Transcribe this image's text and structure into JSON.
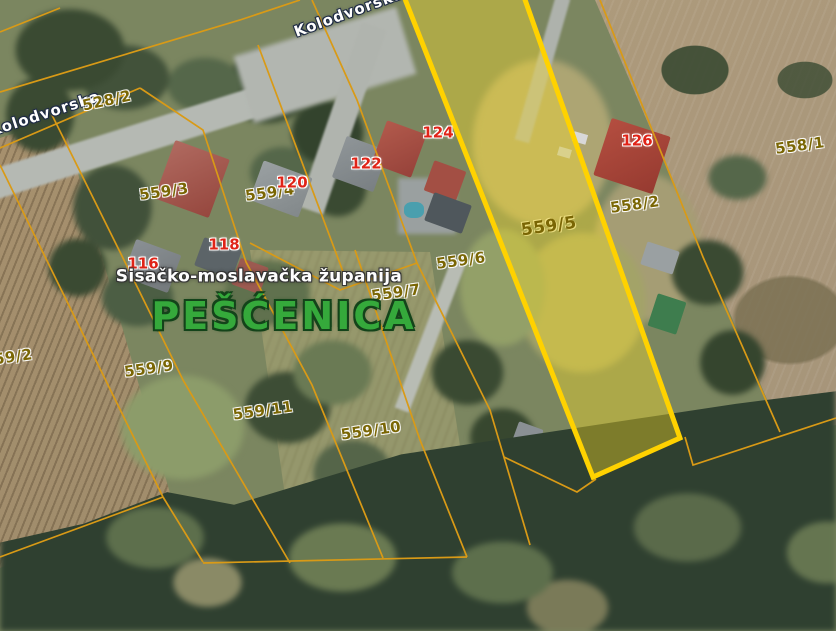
{
  "map": {
    "type": "cadastral-satellite-map",
    "place_label": "PEŠĆENICA",
    "admin_label": "Sisačko-moslavačka županija",
    "street_labels": [
      {
        "text": "Kolodvorska"
      },
      {
        "text": "Kolodvorska"
      }
    ],
    "highlighted_parcel": "559/5",
    "parcel_labels": [
      {
        "label": "528/2"
      },
      {
        "label": "559/3"
      },
      {
        "label": "559/4"
      },
      {
        "label": "559/2"
      },
      {
        "label": "559/9"
      },
      {
        "label": "559/11"
      },
      {
        "label": "559/10"
      },
      {
        "label": "559/7"
      },
      {
        "label": "559/6"
      },
      {
        "label": "559/5"
      },
      {
        "label": "558/2"
      },
      {
        "label": "558/1"
      }
    ],
    "house_numbers": [
      {
        "number": "116"
      },
      {
        "number": "118"
      },
      {
        "number": "120"
      },
      {
        "number": "122"
      },
      {
        "number": "124"
      },
      {
        "number": "126"
      }
    ],
    "colors": {
      "parcel_boundary_line": "#d99a16",
      "highlight_border": "#ffd200",
      "highlight_fill": "rgba(252,224,36,0.38)",
      "parcel_label_text": "#7a6604",
      "house_number_text": "#e02418",
      "street_label_text": "#ffffff",
      "place_label_text": "#35a93b",
      "admin_label_text": "#ffffff"
    }
  }
}
